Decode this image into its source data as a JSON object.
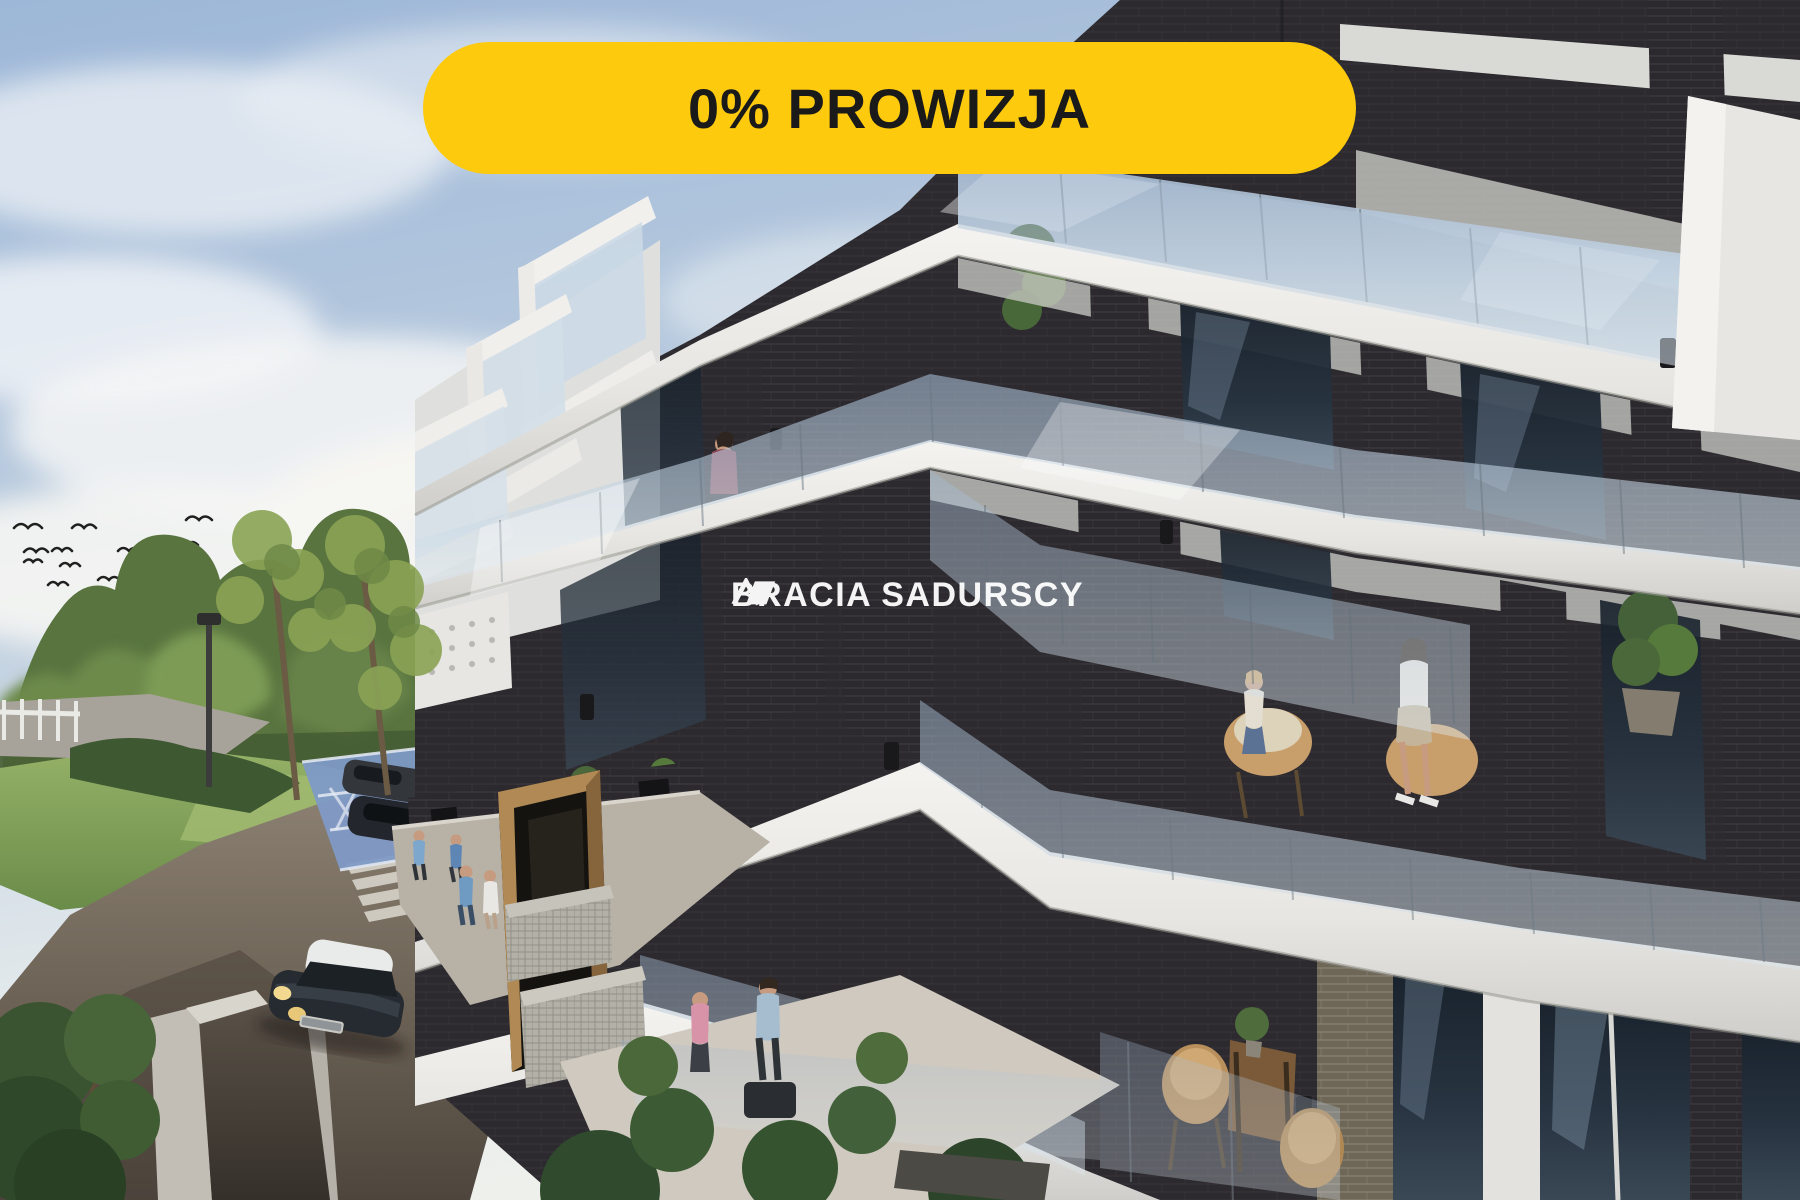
{
  "badge": {
    "label": "0% PROWIZJA",
    "background": "#FDCA0D",
    "text_color": "#1A1A1A"
  },
  "watermark": {
    "brand_first": "BRACIA",
    "brand_second": "SADURSCY",
    "color": "#FFFFFF"
  },
  "palette": {
    "badge_yellow": "#FDCA0D",
    "sky_blue": "#9DB7D8",
    "cloud_white": "#F0F3F5",
    "facade_white": "#EAE9E5",
    "brick_dark": "#2B292D",
    "brick_tan": "#6E6758",
    "glass_blue": "#B7C9DB",
    "lawn_green": "#7FA055",
    "tree_green": "#59743F",
    "road_brown": "#6F6458",
    "parking_blue": "#7F9AC6",
    "wood_portal": "#A88250"
  },
  "scene": {
    "kind": "architectural-render-photo",
    "elements": [
      "sky",
      "clouds",
      "bird-flock",
      "tree-line",
      "lawn",
      "street-lamp",
      "white-fence",
      "road",
      "underground-garage-ramp",
      "crosswalk",
      "disabled-parking-spaces",
      "parked-cars",
      "mini-car",
      "pedestrians",
      "apartment-building",
      "balconies",
      "glass-balustrades",
      "brick-piers",
      "balcony-plants",
      "residents-on-balcony",
      "wooden-entrance-portal",
      "gabion-planters",
      "terrace-couple",
      "balcony-table-set"
    ]
  }
}
